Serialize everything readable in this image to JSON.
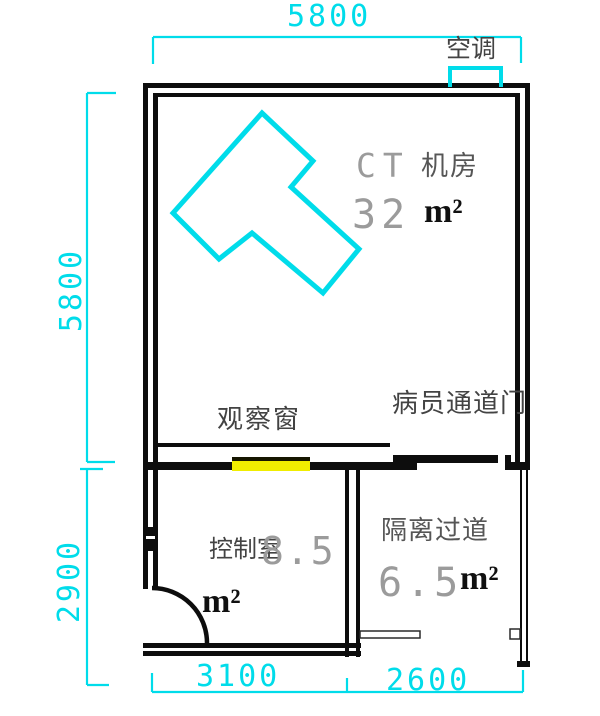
{
  "drawing_type": "CT room floor plan",
  "colors": {
    "dimension_cyan": "#00dcea",
    "machine_cyan": "#00dcea",
    "wall_black": "#0d0d0d",
    "window_yellow": "#f0ed00",
    "numeral_grey": "#9b9b9b",
    "text_grey": "#434343"
  },
  "dimensions": {
    "top_width": "5800",
    "left_upper_height": "5800",
    "left_lower_height": "2900",
    "bottom_left_width": "3100",
    "bottom_right_width": "2600"
  },
  "labels": {
    "air_conditioner": "空调",
    "observation_window": "观察窗",
    "patient_door": "病员通道门"
  },
  "rooms": {
    "ct_room": {
      "name_en": "CT",
      "name_cn": "机房",
      "area_value": "32",
      "area_unit": "m²"
    },
    "control_room": {
      "name": "控制室",
      "area_value": "8.5",
      "area_unit": "m²"
    },
    "isolation_corridor": {
      "name": "隔离过道",
      "area_value": "6.5",
      "area_unit": "m²"
    }
  }
}
